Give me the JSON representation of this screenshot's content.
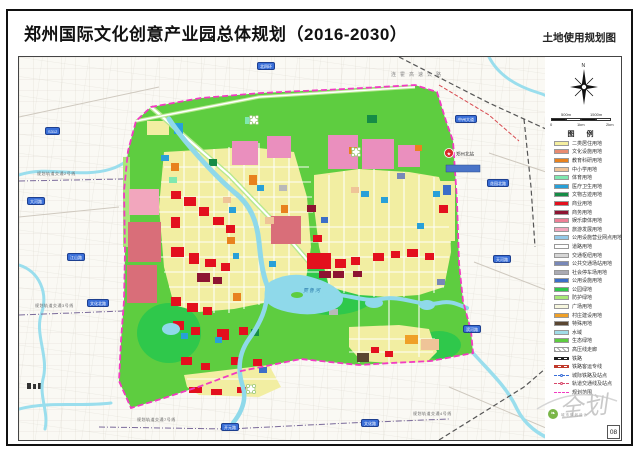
{
  "page": {
    "title": "郑州国际文化创意产业园总体规划（2016-2030）",
    "subtitle": "土地使用规划图",
    "page_number": "08"
  },
  "compass": {
    "north_label": "N"
  },
  "scalebar": {
    "top_labels": [
      "500m",
      "1500m"
    ],
    "bottom_labels": [
      "0",
      "1km",
      "2km"
    ]
  },
  "legend": {
    "title": "图  例",
    "items": [
      {
        "label": "二类居住用地",
        "style": "swatch",
        "color": "#F5EFA0"
      },
      {
        "label": "文化设施用地",
        "style": "swatch",
        "color": "#E88B70"
      },
      {
        "label": "教育科研用地",
        "style": "swatch",
        "color": "#E8821E"
      },
      {
        "label": "中小学用地",
        "style": "swatch",
        "color": "#EFC498"
      },
      {
        "label": "体育用地",
        "style": "swatch",
        "color": "#7FE8B0"
      },
      {
        "label": "医疗卫生用地",
        "style": "swatch",
        "color": "#28A0D8"
      },
      {
        "label": "文物古迹用地",
        "style": "swatch",
        "color": "#168C46"
      },
      {
        "label": "商业用地",
        "style": "swatch",
        "color": "#E3101E"
      },
      {
        "label": "商务用地",
        "style": "swatch",
        "color": "#8D1432"
      },
      {
        "label": "娱乐康体用地",
        "style": "swatch",
        "color": "#EE7F96"
      },
      {
        "label": "旅游发展用地",
        "style": "swatch",
        "color": "#F2A6BD"
      },
      {
        "label": "公用设施营业网点用地",
        "style": "swatch",
        "color": "#93C9E8"
      },
      {
        "label": "道路用地",
        "style": "swatch",
        "color": "#FFFFFF"
      },
      {
        "label": "交通枢纽用地",
        "style": "swatch",
        "color": "#D6D6D6"
      },
      {
        "label": "公共交通场站用地",
        "style": "swatch",
        "color": "#7888B8"
      },
      {
        "label": "社会停车场用地",
        "style": "swatch",
        "color": "#ABABB3"
      },
      {
        "label": "公用设施用地",
        "style": "swatch",
        "color": "#3C6EC8"
      },
      {
        "label": "公园绿地",
        "style": "swatch",
        "color": "#2FC84B"
      },
      {
        "label": "防护绿地",
        "style": "swatch",
        "color": "#A8E878"
      },
      {
        "label": "广场用地",
        "style": "swatch",
        "color": "#F7F7DF"
      },
      {
        "label": "村庄建设用地",
        "style": "swatch",
        "color": "#EFA028"
      },
      {
        "label": "特殊用地",
        "style": "swatch",
        "color": "#5A4632"
      },
      {
        "label": "水域",
        "style": "swatch",
        "color": "#A0DCE8"
      },
      {
        "label": "生态绿地",
        "style": "swatch",
        "color": "#5ECD40"
      },
      {
        "label": "高压线走廊",
        "style": "striped"
      },
      {
        "label": "铁路",
        "style": "rail"
      },
      {
        "label": "铁路客运专线",
        "style": "rail2"
      },
      {
        "label": "城际铁路及站点",
        "style": "intercity"
      },
      {
        "label": "轨道交通线及站点",
        "style": "metro"
      },
      {
        "label": "规划范围",
        "style": "boundary"
      }
    ]
  },
  "map": {
    "expressway_label": "连霍高速公路",
    "river_label": "贾鲁河",
    "station_label": "郑州北站",
    "boundary_color": "#F23BC2",
    "base_green": "#5ECD40",
    "water_color": "#8FD9EA",
    "badges": [
      {
        "x": 238,
        "y": 5,
        "label": "北四环"
      },
      {
        "x": 26,
        "y": 70,
        "label": "S312"
      },
      {
        "x": 8,
        "y": 140,
        "label": "大河路"
      },
      {
        "x": 48,
        "y": 196,
        "label": "江山路"
      },
      {
        "x": 68,
        "y": 242,
        "label": "文化北路"
      },
      {
        "x": 436,
        "y": 58,
        "label": "中州大道"
      },
      {
        "x": 468,
        "y": 122,
        "label": "花园北路"
      },
      {
        "x": 474,
        "y": 198,
        "label": "天河路"
      },
      {
        "x": 444,
        "y": 268,
        "label": "滨河路"
      },
      {
        "x": 202,
        "y": 366,
        "label": "开元路"
      },
      {
        "x": 342,
        "y": 362,
        "label": "文化路"
      }
    ],
    "metro_labels": [
      {
        "x": 18,
        "y": 114,
        "label": "规划轨道交通2号线"
      },
      {
        "x": 16,
        "y": 246,
        "label": "规划轨道交通3号线"
      },
      {
        "x": 118,
        "y": 360,
        "label": "规划轨道交通7号线"
      },
      {
        "x": 394,
        "y": 354,
        "label": "规划轨道交通4号线"
      }
    ]
  },
  "watermark": {
    "script": "全划",
    "studio": "城市规划设计"
  }
}
